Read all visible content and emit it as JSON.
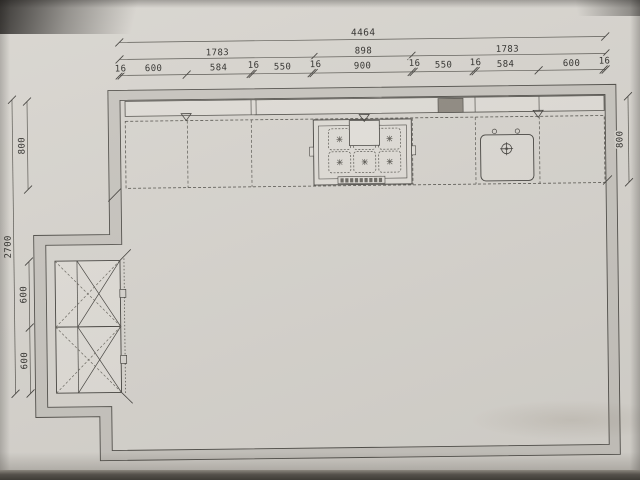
{
  "drawing": {
    "type": "kitchen-floor-plan-photo",
    "dims": {
      "top_overall": "4464",
      "top_row2": [
        "1783",
        "898",
        "1783"
      ],
      "top_row3": [
        "16",
        "600",
        "584",
        "16",
        "550",
        "16",
        "900",
        "16",
        "550",
        "16",
        "584",
        "600",
        "16"
      ],
      "left_overall": "2700",
      "left_segments": [
        "800",
        "600",
        "600"
      ],
      "right_depth": "800"
    },
    "symbols": [
      "connection-triangle",
      "cooktop",
      "extractor-canopy",
      "sink",
      "faucet",
      "tall-cabinet-x",
      "dark-appliance-box"
    ],
    "colors": {
      "paper": "#d7d4ce",
      "line": "#44423e",
      "wall_fill": "#c7c4be",
      "cabinet_fill": "#dfdcd6",
      "appliance_dark": "#8f8a81"
    }
  }
}
